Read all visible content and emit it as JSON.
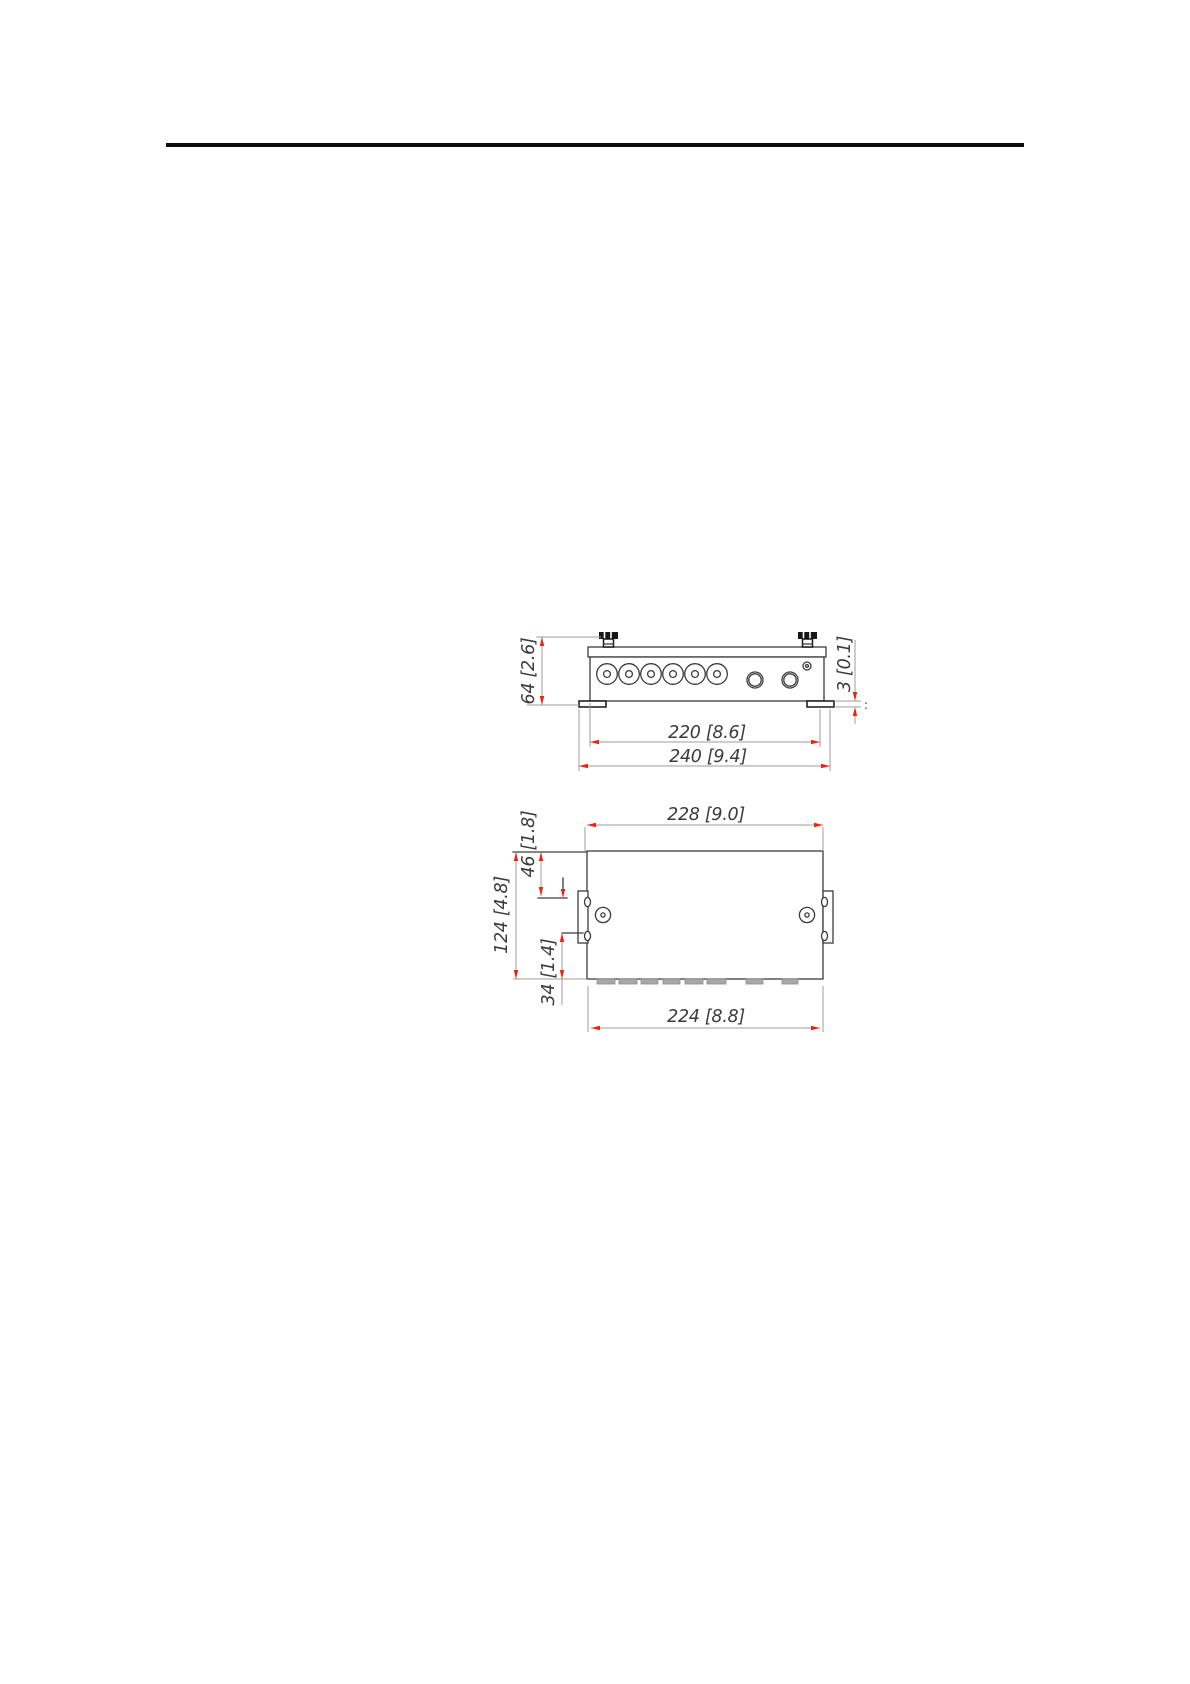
{
  "colors": {
    "arrow_red": "#ee2211",
    "line_dark": "#3c3c3c",
    "line_black": "#161616",
    "extension_gray": "#9c9c9c",
    "slot_gray": "#a8a8a8"
  },
  "front_view": {
    "dim_height": "64 [2.6]",
    "dim_width_inner": "220 [8.6]",
    "dim_width_outer": "240 [9.4]",
    "dim_flange_thickness": "3 [0.1]",
    "tick_mark": ":",
    "features": {
      "thumbscrews": 2,
      "round_connectors": 6,
      "jack_connectors": 2,
      "ground_screw": 1,
      "mounting_feet": 2
    }
  },
  "top_view": {
    "dim_width_top": "228 [9.0]",
    "dim_height": "124 [4.8]",
    "dim_slot_offset_top": "46 [1.8]",
    "dim_slot_offset_bottom": "34 [1.4]",
    "dim_width_bottom": "224 [8.8]",
    "features": {
      "screw_holes": 2,
      "mounting_brackets": 2,
      "bracket_slots": 4,
      "vent_slots": 8
    }
  }
}
